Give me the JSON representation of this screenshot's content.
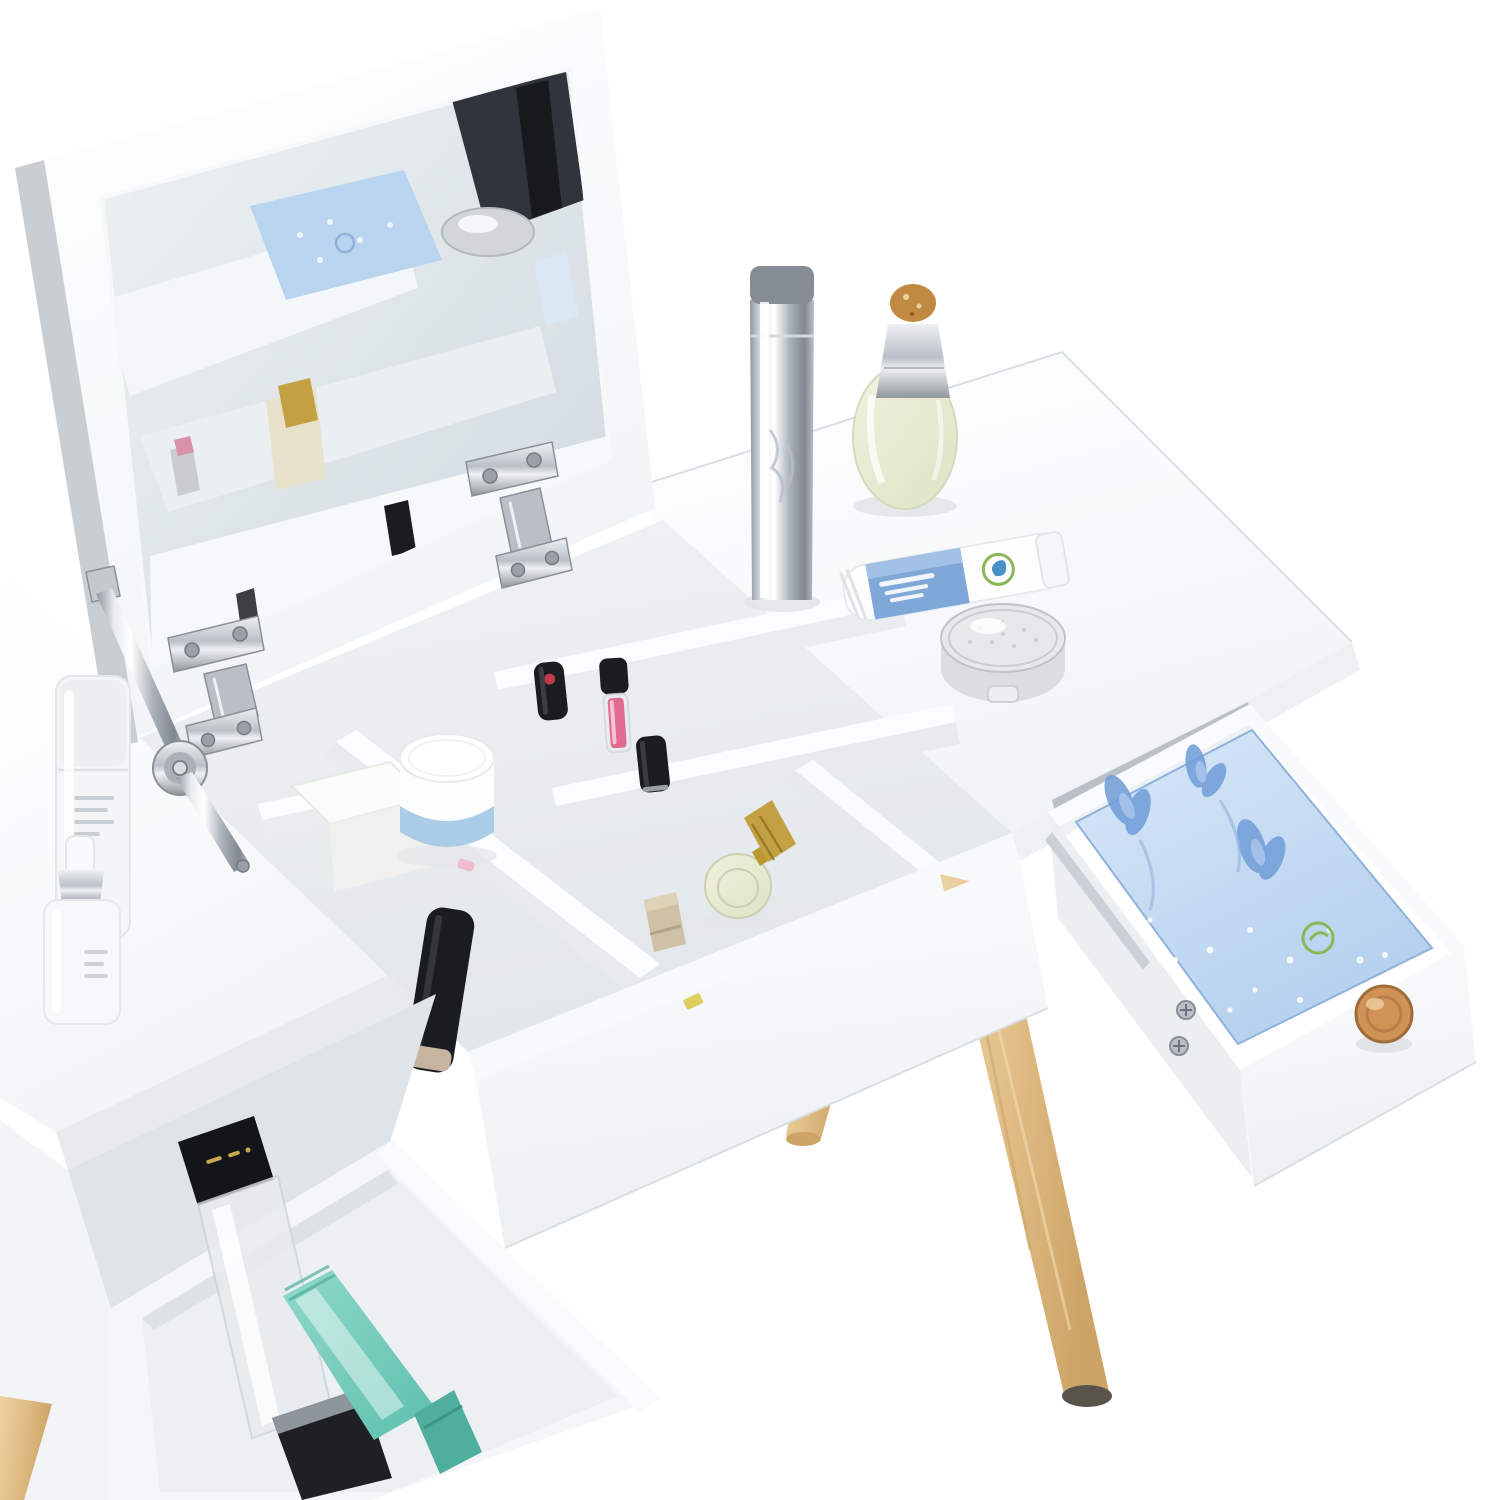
{
  "meta": {
    "type": "product-photo",
    "subject": "White vanity dressing table with flip-up mirror lid, open storage compartment, pulled-out drawers and splayed beech wood legs on a pure white background"
  },
  "palette": {
    "background": "#ffffff",
    "surfaceShade": "#f1f4f6",
    "sideFace": "#e9edf0",
    "edgeLine": "#d9dee2",
    "cavityShade": "#dfe4e8",
    "mirrorLight": "#eef2f4",
    "mirrorDark": "#cfd9df",
    "reflectionDark": "#2f353a",
    "chromeLight": "#eef1f4",
    "chromeMid": "#b9c0c6",
    "chromeDark": "#8f969c",
    "woodLight": "#ecd2a2",
    "woodMid": "#e0bd85",
    "woodDark": "#cda366",
    "footCap": "#59544b",
    "knobWood": "#cf9358",
    "knobRing": "#a06c38",
    "linerLight": "#d8e7f7",
    "linerDeep": "#b4d0ee",
    "linerEdge": "#8fb2dc",
    "flowerBlue": "#6f9cd8",
    "flowerLight": "#a8c4ea",
    "dotWhite": "#ffffff",
    "labelBlue": "#7fa8d9",
    "labelBlueLight": "#a9c6e8",
    "logoGreen": "#8ab858",
    "logoDrop": "#4a90c8",
    "tealLight": "#8fd8c9",
    "tealDeep": "#5fc0ae",
    "tealCap": "#4fae9c",
    "pinkGloss": "#e06a90",
    "redDot": "#c23b4a",
    "goldCap": "#c3a143",
    "amberStopper": "#c08a42",
    "perfumeGlassLight": "#f0f2de",
    "perfumeGlassDeep": "#dde3c4",
    "creamLabel": "#a7c9e6",
    "blackCosmetic": "#1b1c1f",
    "champagne": "#cfc1a4"
  },
  "objects": {
    "mirror_lid": "flip-up lid opened, square mirror on its underside reflecting compartment, blue liner box, silver compact and gold bottle",
    "hardware": [
      "chrome soft-close hinge left",
      "chrome soft-close hinge right",
      "chrome lid support arm with pivot disc"
    ],
    "right_tabletop_items": [
      "silver spray cylinder with grey cap",
      "oval perfume bottle with silver neck and amber stopper",
      "white lotion tube with blue label and green logo",
      "round silver cushion compact"
    ],
    "compartment_items": [
      "white tissue box",
      "white cream jar with blue label",
      "black lipstick with red dot",
      "pink lip gloss with black cap",
      "black lipstick",
      "gold mini perfume bottle",
      "champagne lipstick tube",
      "black mascara bottle on front rim",
      "yellow sticker"
    ],
    "right_drawer": "pulled out, blue floral paper liner, wooden round knob, two screws on side panel",
    "left_tabletop_items": [
      "tall frosted toner bottle",
      "white pump bottle with silver collar"
    ],
    "left_drawer_items": [
      "clear bottle with black cap and gold lettering",
      "mint-teal cleanser tube"
    ],
    "legs": [
      "far-left beech leg",
      "back-left beech leg stub",
      "long front beech leg with dark foot cap"
    ]
  }
}
